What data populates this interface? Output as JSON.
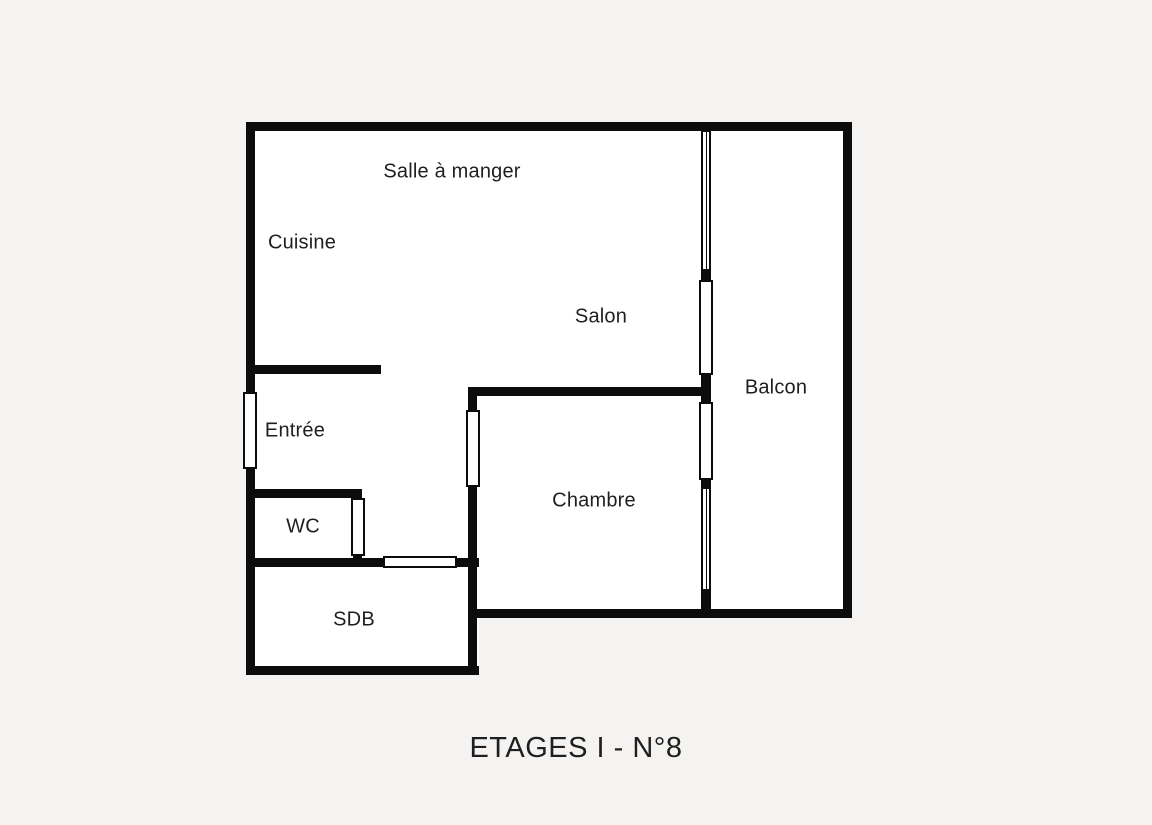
{
  "title": {
    "text": "ETAGES I - N°8"
  },
  "floor_plan": {
    "colors": {
      "background": "#f4f3f1",
      "wall": "#0c0c0c",
      "interior": "#ffffff",
      "text": "#1f1f1f"
    },
    "rooms": [
      "Salle à manger",
      "Cuisine",
      "Salon",
      "Balcon",
      "Entrée",
      "WC",
      "Chambre",
      "SDB"
    ],
    "interior_rects": [
      {
        "name": "apartment-interior",
        "x": 246,
        "y": 122,
        "w": 606,
        "h": 495
      },
      {
        "name": "sdb-interior",
        "x": 246,
        "y": 558,
        "w": 233,
        "h": 117
      }
    ],
    "walls": [
      {
        "name": "wall-top-exterior",
        "x": 246,
        "y": 122,
        "w": 606,
        "h": 9
      },
      {
        "name": "wall-left-exterior",
        "x": 246,
        "y": 122,
        "w": 9,
        "h": 553
      },
      {
        "name": "wall-right-exterior",
        "x": 843,
        "y": 122,
        "w": 9,
        "h": 495
      },
      {
        "name": "wall-bottom-main",
        "x": 468,
        "y": 609,
        "w": 384,
        "h": 9
      },
      {
        "name": "wall-bottom-sdb",
        "x": 246,
        "y": 666,
        "w": 233,
        "h": 9
      },
      {
        "name": "wall-chambre-left",
        "x": 468,
        "y": 387,
        "w": 9,
        "h": 288
      },
      {
        "name": "wall-chambre-top",
        "x": 468,
        "y": 387,
        "w": 243,
        "h": 9
      },
      {
        "name": "wall-balcony-divider",
        "x": 701,
        "y": 122,
        "w": 10,
        "h": 495
      },
      {
        "name": "wall-entree-stub",
        "x": 246,
        "y": 365,
        "w": 135,
        "h": 9
      },
      {
        "name": "wall-wc-top",
        "x": 246,
        "y": 489,
        "w": 116,
        "h": 9
      },
      {
        "name": "wall-wc-right",
        "x": 353,
        "y": 489,
        "w": 9,
        "h": 78
      },
      {
        "name": "wall-sdb-top",
        "x": 246,
        "y": 558,
        "w": 233,
        "h": 9
      }
    ],
    "openings": [
      {
        "name": "entree-entry-door",
        "type": "panel",
        "x": 243,
        "y": 392,
        "w": 14,
        "h": 77
      },
      {
        "name": "balcony-window-upper",
        "type": "window",
        "x": 702,
        "y": 131,
        "w": 8,
        "h": 139
      },
      {
        "name": "balcony-door-salon",
        "type": "panel",
        "x": 699,
        "y": 280,
        "w": 14,
        "h": 95
      },
      {
        "name": "balcony-door-chambre",
        "type": "panel",
        "x": 699,
        "y": 402,
        "w": 14,
        "h": 78
      },
      {
        "name": "balcony-window-lower",
        "type": "window",
        "x": 702,
        "y": 488,
        "w": 8,
        "h": 102
      },
      {
        "name": "chambre-door",
        "type": "panel",
        "x": 466,
        "y": 410,
        "w": 14,
        "h": 77
      },
      {
        "name": "wc-door",
        "type": "panel",
        "x": 351,
        "y": 498,
        "w": 14,
        "h": 58
      },
      {
        "name": "sdb-door",
        "type": "panel",
        "x": 383,
        "y": 556,
        "w": 74,
        "h": 12
      }
    ],
    "labels": [
      {
        "name": "label-salle-a-manger",
        "text": "Salle à manger",
        "cx": 452,
        "cy": 172
      },
      {
        "name": "label-cuisine",
        "text": "Cuisine",
        "cx": 302,
        "cy": 243
      },
      {
        "name": "label-salon",
        "text": "Salon",
        "cx": 601,
        "cy": 317
      },
      {
        "name": "label-balcon",
        "text": "Balcon",
        "cx": 776,
        "cy": 388
      },
      {
        "name": "label-entree",
        "text": "Entrée",
        "cx": 295,
        "cy": 431
      },
      {
        "name": "label-wc",
        "text": "WC",
        "cx": 303,
        "cy": 527
      },
      {
        "name": "label-chambre",
        "text": "Chambre",
        "cx": 594,
        "cy": 501
      },
      {
        "name": "label-sdb",
        "text": "SDB",
        "cx": 354,
        "cy": 620
      }
    ]
  }
}
